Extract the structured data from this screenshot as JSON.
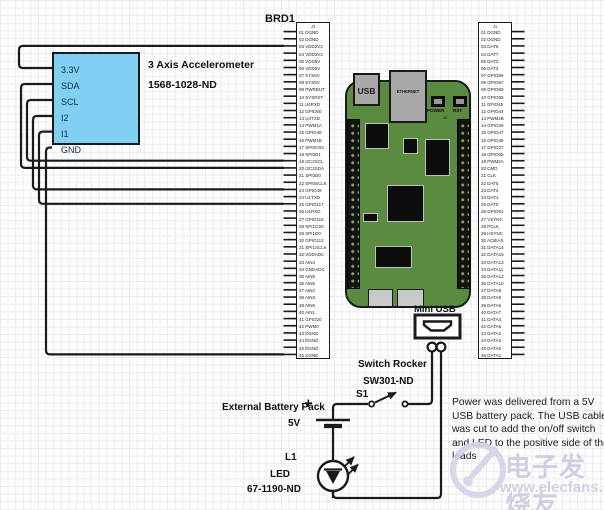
{
  "diagram": {
    "board_ref": "BRD1",
    "accelerometer": {
      "pins": [
        "3.3V",
        "SDA",
        "SCL",
        "I2",
        "I1",
        "GND"
      ],
      "title_line1": "3 Axis Accelerometer",
      "title_line2": "1568-1028-ND"
    },
    "board": {
      "usb_label": "USB",
      "ethernet_label": "ETHERNET",
      "power_button_label": "POWER",
      "reset_button_label": "RST",
      "silkscreen_ref": "J2"
    },
    "headers": {
      "left": {
        "ref": "J3",
        "pins": [
          "01 DGND",
          "02 DGND",
          "03 VDD3V3",
          "04 VDD3V3",
          "05 VDD5V",
          "06 VDD5V",
          "07 SYS5V",
          "08 SYS5V",
          "09 PWRBUT",
          "10 SYSRST",
          "11 U4RXD",
          "12 GPIO60",
          "13 U4TXD",
          "14 PWM1A",
          "15 GPIO48",
          "16 PWM1B",
          "17 SPI0CS0",
          "18 SPI0D1",
          "19 I2C2SCL",
          "20 I2C2SDA",
          "21 SPI0D0",
          "22 SPI0SCLK",
          "23 GPIO49",
          "24 U1TXD",
          "25 GPIO117",
          "26 U1RXD",
          "27 GPIO115",
          "28 SPI1CS0",
          "29 SPI1D0",
          "30 GPIO112",
          "31 SPI1SCLK",
          "32 VDDADC",
          "33 AIN4",
          "34 GNDADC",
          "35 AIN6",
          "36 AIN5",
          "37 AIN2",
          "38 AIN3",
          "39 AIN0",
          "40 AIN1",
          "41 GPIO20",
          "42 PWM0",
          "43 DGND",
          "44 DGND",
          "45 DGND",
          "46 DGND"
        ]
      },
      "right": {
        "ref": "J1",
        "pins": [
          "01 DGND",
          "02 DGND",
          "03 DAT6",
          "04 DAT7",
          "05 DAT2",
          "06 DAT3",
          "07 GPIO66",
          "08 GPIO67",
          "09 GPIO69",
          "10 GPIO68",
          "11 GPIO45",
          "12 GPIO44",
          "13 PWM2B",
          "14 GPIO26",
          "15 GPIO47",
          "16 GPIO46",
          "17 GPIO27",
          "18 GPIO65",
          "19 PWM2A",
          "20 CMD",
          "21 CLK",
          "22 DAT5",
          "23 DAT4",
          "24 DAT1",
          "25 DAT0",
          "26 GPIO61",
          "27 VSYNC",
          "28 PCLK",
          "29 HSYNC",
          "30 ACBIAS",
          "31 DATA14",
          "32 DATA15",
          "33 DATA13",
          "34 DATA11",
          "35 DATA12",
          "36 DATA10",
          "37 DATA8",
          "38 DATA9",
          "39 DATA6",
          "40 DATA7",
          "41 DATA4",
          "42 DATA5",
          "43 DATA2",
          "44 DATA3",
          "45 DATA0",
          "46 DATA1"
        ]
      }
    },
    "mini_usb_label": "Mini USB",
    "switch": {
      "label": "Switch Rocker",
      "part": "SW301-ND",
      "ref": "S1"
    },
    "battery": {
      "label": "External Battery Pack",
      "voltage": "5V",
      "plus": "+"
    },
    "led": {
      "ref": "L1",
      "label": "LED",
      "part": "67-1190-ND"
    },
    "note": "Power was delivered from a 5V USB battery pack. The USB cable was cut to add the on/off switch and LED to the positive side of the leads",
    "colors": {
      "board_green": "#5a8b41",
      "accel_blue": "#7fd0f2",
      "wire": "#1a1a1a"
    }
  },
  "watermark": {
    "brand_cn": "电子发烧友",
    "url": "www.elecfans.com"
  }
}
